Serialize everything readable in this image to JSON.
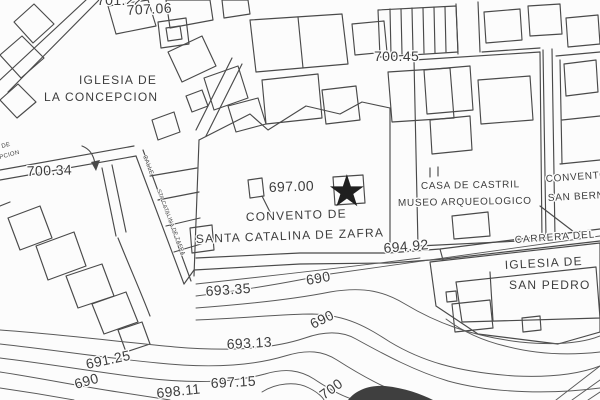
{
  "map": {
    "colors": {
      "background": "#fcfcfc",
      "line_ink": "#4a4a4a",
      "contour_ink": "#5a5a5a",
      "text_ink": "#3d3d3d",
      "star": "#1f1f1f"
    },
    "icons": {
      "location_star": "★"
    },
    "labels": {
      "concepcion1": "IGLESIA DE",
      "concepcion2": "LA CONCEPCION",
      "convento1": "CONVENTO DE",
      "convento2": "SANTA CATALINA DE ZAFRA",
      "castril1": "CASA DE CASTRIL",
      "castril2": "MUSEO ARQUEOLOGICO",
      "bernardo1": "CONVENTO",
      "bernardo2": "SAN BERN",
      "sanpedro1": "IGLESIA DE",
      "sanpedro2": "SAN PEDRO",
      "carrera": "CARRERA DEL",
      "calle1": "CALLE",
      "calle2": "STA CATALINA DE ZAFRA",
      "edge1": "DE",
      "edge2": "PCION"
    },
    "elevations": {
      "clipped_top": "701.22",
      "p707_06": "707.06",
      "p700_45": "700.45",
      "p700_34": "700.34",
      "p697_00": "697.00",
      "p694_92": "694.92",
      "p693_35": "693.35",
      "p691_25": "691.25",
      "p693_13": "693.13",
      "p697_15": "697.15",
      "p698_11": "698.11",
      "c690_a": "690",
      "c690_b": "690",
      "c690_c": "690",
      "c700": "700"
    }
  }
}
